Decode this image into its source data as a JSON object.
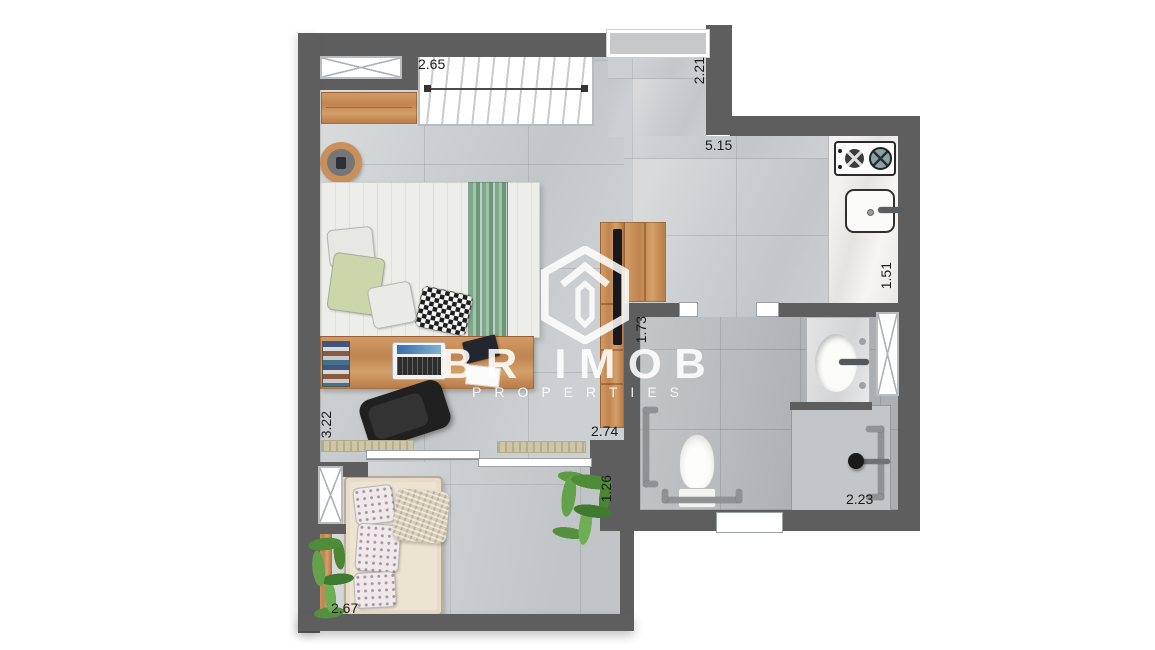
{
  "image_type": "apartment-floor-plan",
  "watermark": {
    "brand": "BR IMOB",
    "tagline": "PROPERTIES",
    "logo_icon": "hexagon-m-logo"
  },
  "measurements": [
    {
      "value": "2.65",
      "x": 418,
      "y": 57,
      "dir": "h"
    },
    {
      "value": "2.21",
      "x": 692,
      "y": 57,
      "dir": "v"
    },
    {
      "value": "5.15",
      "x": 705,
      "y": 138,
      "dir": "h"
    },
    {
      "value": "1.51",
      "x": 879,
      "y": 262,
      "dir": "v"
    },
    {
      "value": "1.73",
      "x": 634,
      "y": 316,
      "dir": "v"
    },
    {
      "value": "2.74",
      "x": 591,
      "y": 424,
      "dir": "h"
    },
    {
      "value": "3.22",
      "x": 319,
      "y": 411,
      "dir": "v"
    },
    {
      "value": "1.26",
      "x": 599,
      "y": 475,
      "dir": "v"
    },
    {
      "value": "2.23",
      "x": 846,
      "y": 492,
      "dir": "h"
    },
    {
      "value": "2.67",
      "x": 331,
      "y": 601,
      "dir": "h"
    }
  ],
  "colors": {
    "wall": "#5e5e5e",
    "floor_main": "#cdd0d2",
    "floor_bathroom": "#b7babc",
    "floor_balcony": "#cbced0",
    "wood": "#c08550",
    "bed_runner_green": "#7fa98b",
    "pillow_green": "#ccd6ab",
    "plant_green": "#4f8c38",
    "label_text": "#1b1b1b",
    "watermark_white": "#ffffff"
  }
}
